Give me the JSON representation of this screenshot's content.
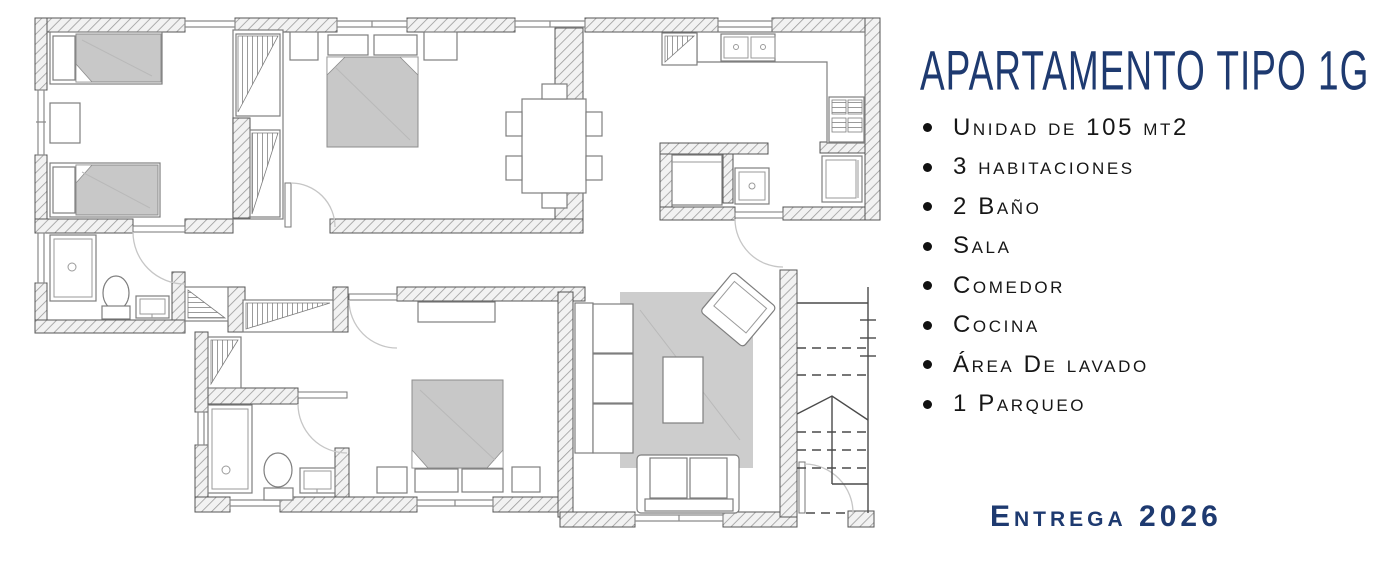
{
  "title": "Apartamento Tipo 1G",
  "features": [
    "Unidad de 105 mt2",
    "3 habitaciones",
    "2 Baño",
    "Sala",
    "Comedor",
    "Cocina",
    "Área De lavado",
    "1 Parqueo"
  ],
  "delivery": "Entrega 2026",
  "colors": {
    "accent_navy": "#1e3a70",
    "body_text": "#161616",
    "wall_line": "#555555",
    "furniture_gray": "#c8c8c8"
  },
  "floorplan": {
    "label": "Apartment type 1G architectural floor plan"
  }
}
